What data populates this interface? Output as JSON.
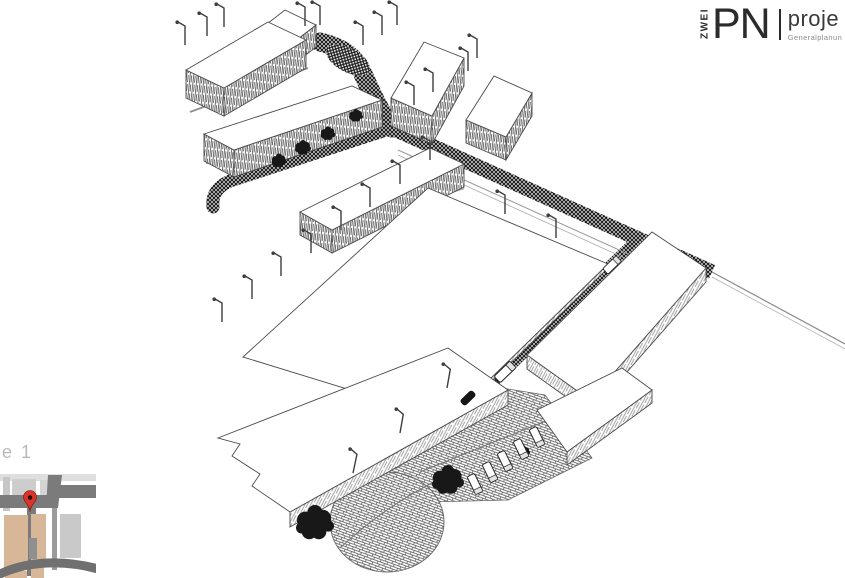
{
  "logo": {
    "vertical_text": "ZWEI",
    "main_text": "PN",
    "tagline_top": "proje",
    "tagline_bottom": "Generalplanun",
    "text_color": "#2b2b2b"
  },
  "map_inset": {
    "label": "e 1",
    "pin_color": "#d8342a",
    "pin_dot_color": "#2a0a06",
    "building_color": "#d7b797",
    "road_color": "#7b7b7b",
    "light_block_color": "#c9c9c9"
  },
  "illustration": {
    "type": "hand-drawn pencil aerial axonometric sketch of an industrial / campus site",
    "ink_color": "#2e2e2e",
    "ground_color": "#ffffff",
    "buildings_count": 10,
    "features": "hatched roads, street lamp rows, dark tree blobs, trucks at loading dock, circular paved plaza"
  }
}
